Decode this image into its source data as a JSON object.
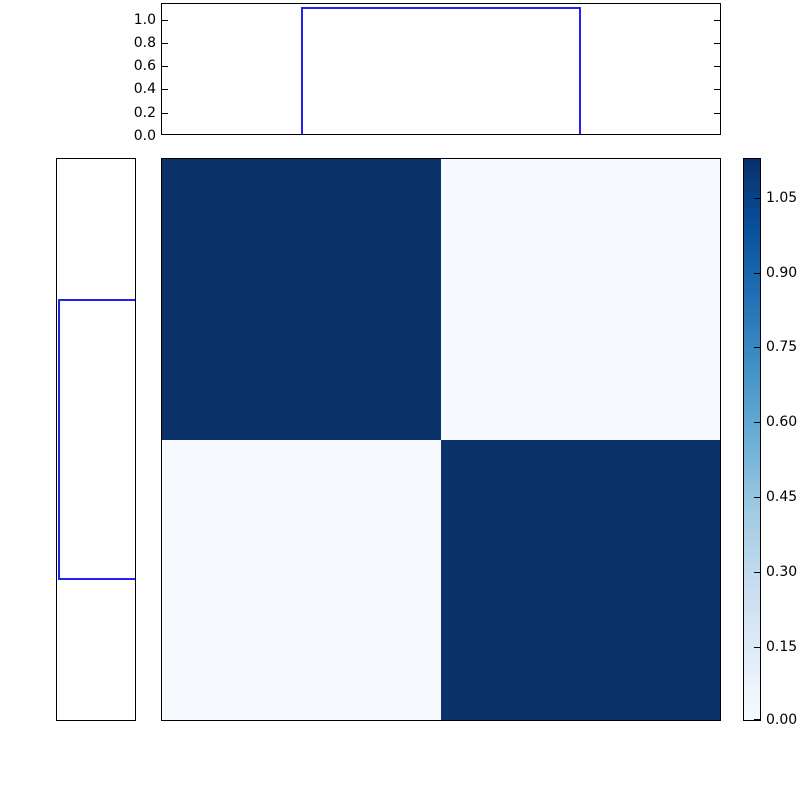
{
  "figure": {
    "background": "#ffffff",
    "line_color": "#2222ee",
    "heatmap_dark_color": "#0a3269",
    "heatmap_light_color": "#f6f9fe",
    "colormap": "Blues"
  },
  "top_axes": {
    "yticks": [
      "0.0",
      "0.2",
      "0.4",
      "0.6",
      "0.8",
      "1.0"
    ]
  },
  "colorbar": {
    "ticks": [
      "1.05",
      "0.90",
      "0.75",
      "0.60",
      "0.45",
      "0.30",
      "0.15",
      "0.00"
    ]
  },
  "chart_data": [
    {
      "type": "line",
      "name": "top-marginal-step-function",
      "x_fraction": [
        0.0,
        0.25,
        0.25,
        0.75,
        0.75,
        1.0
      ],
      "y": [
        0.0,
        0.0,
        1.1,
        1.1,
        0.0,
        0.0
      ],
      "ylim": [
        0.0,
        1.14
      ],
      "yticks": [
        0.0,
        0.2,
        0.4,
        0.6,
        0.8,
        1.0
      ],
      "line_color": "#0000ff",
      "grid": false,
      "title": "",
      "xlabel": "",
      "ylabel": ""
    },
    {
      "type": "line",
      "name": "left-marginal-step-function-rotated",
      "y_fraction": [
        0.0,
        0.25,
        0.25,
        0.75,
        0.75,
        1.0
      ],
      "value": [
        0.0,
        0.0,
        1.1,
        1.1,
        0.0,
        0.0
      ],
      "value_axis": "horizontal, 0 at right edge, max ~1.14 at left edge",
      "line_color": "#0000ff",
      "grid": false
    },
    {
      "type": "heatmap",
      "name": "block-similarity-matrix",
      "matrix": [
        [
          1.1,
          0.02
        ],
        [
          0.02,
          1.1
        ]
      ],
      "colormap": "Blues",
      "vmin": 0.0,
      "vmax": 1.128,
      "colorbar_ticks": [
        0.0,
        0.15,
        0.3,
        0.45,
        0.6,
        0.75,
        0.9,
        1.05
      ],
      "legend_position": "right-colorbar"
    }
  ]
}
